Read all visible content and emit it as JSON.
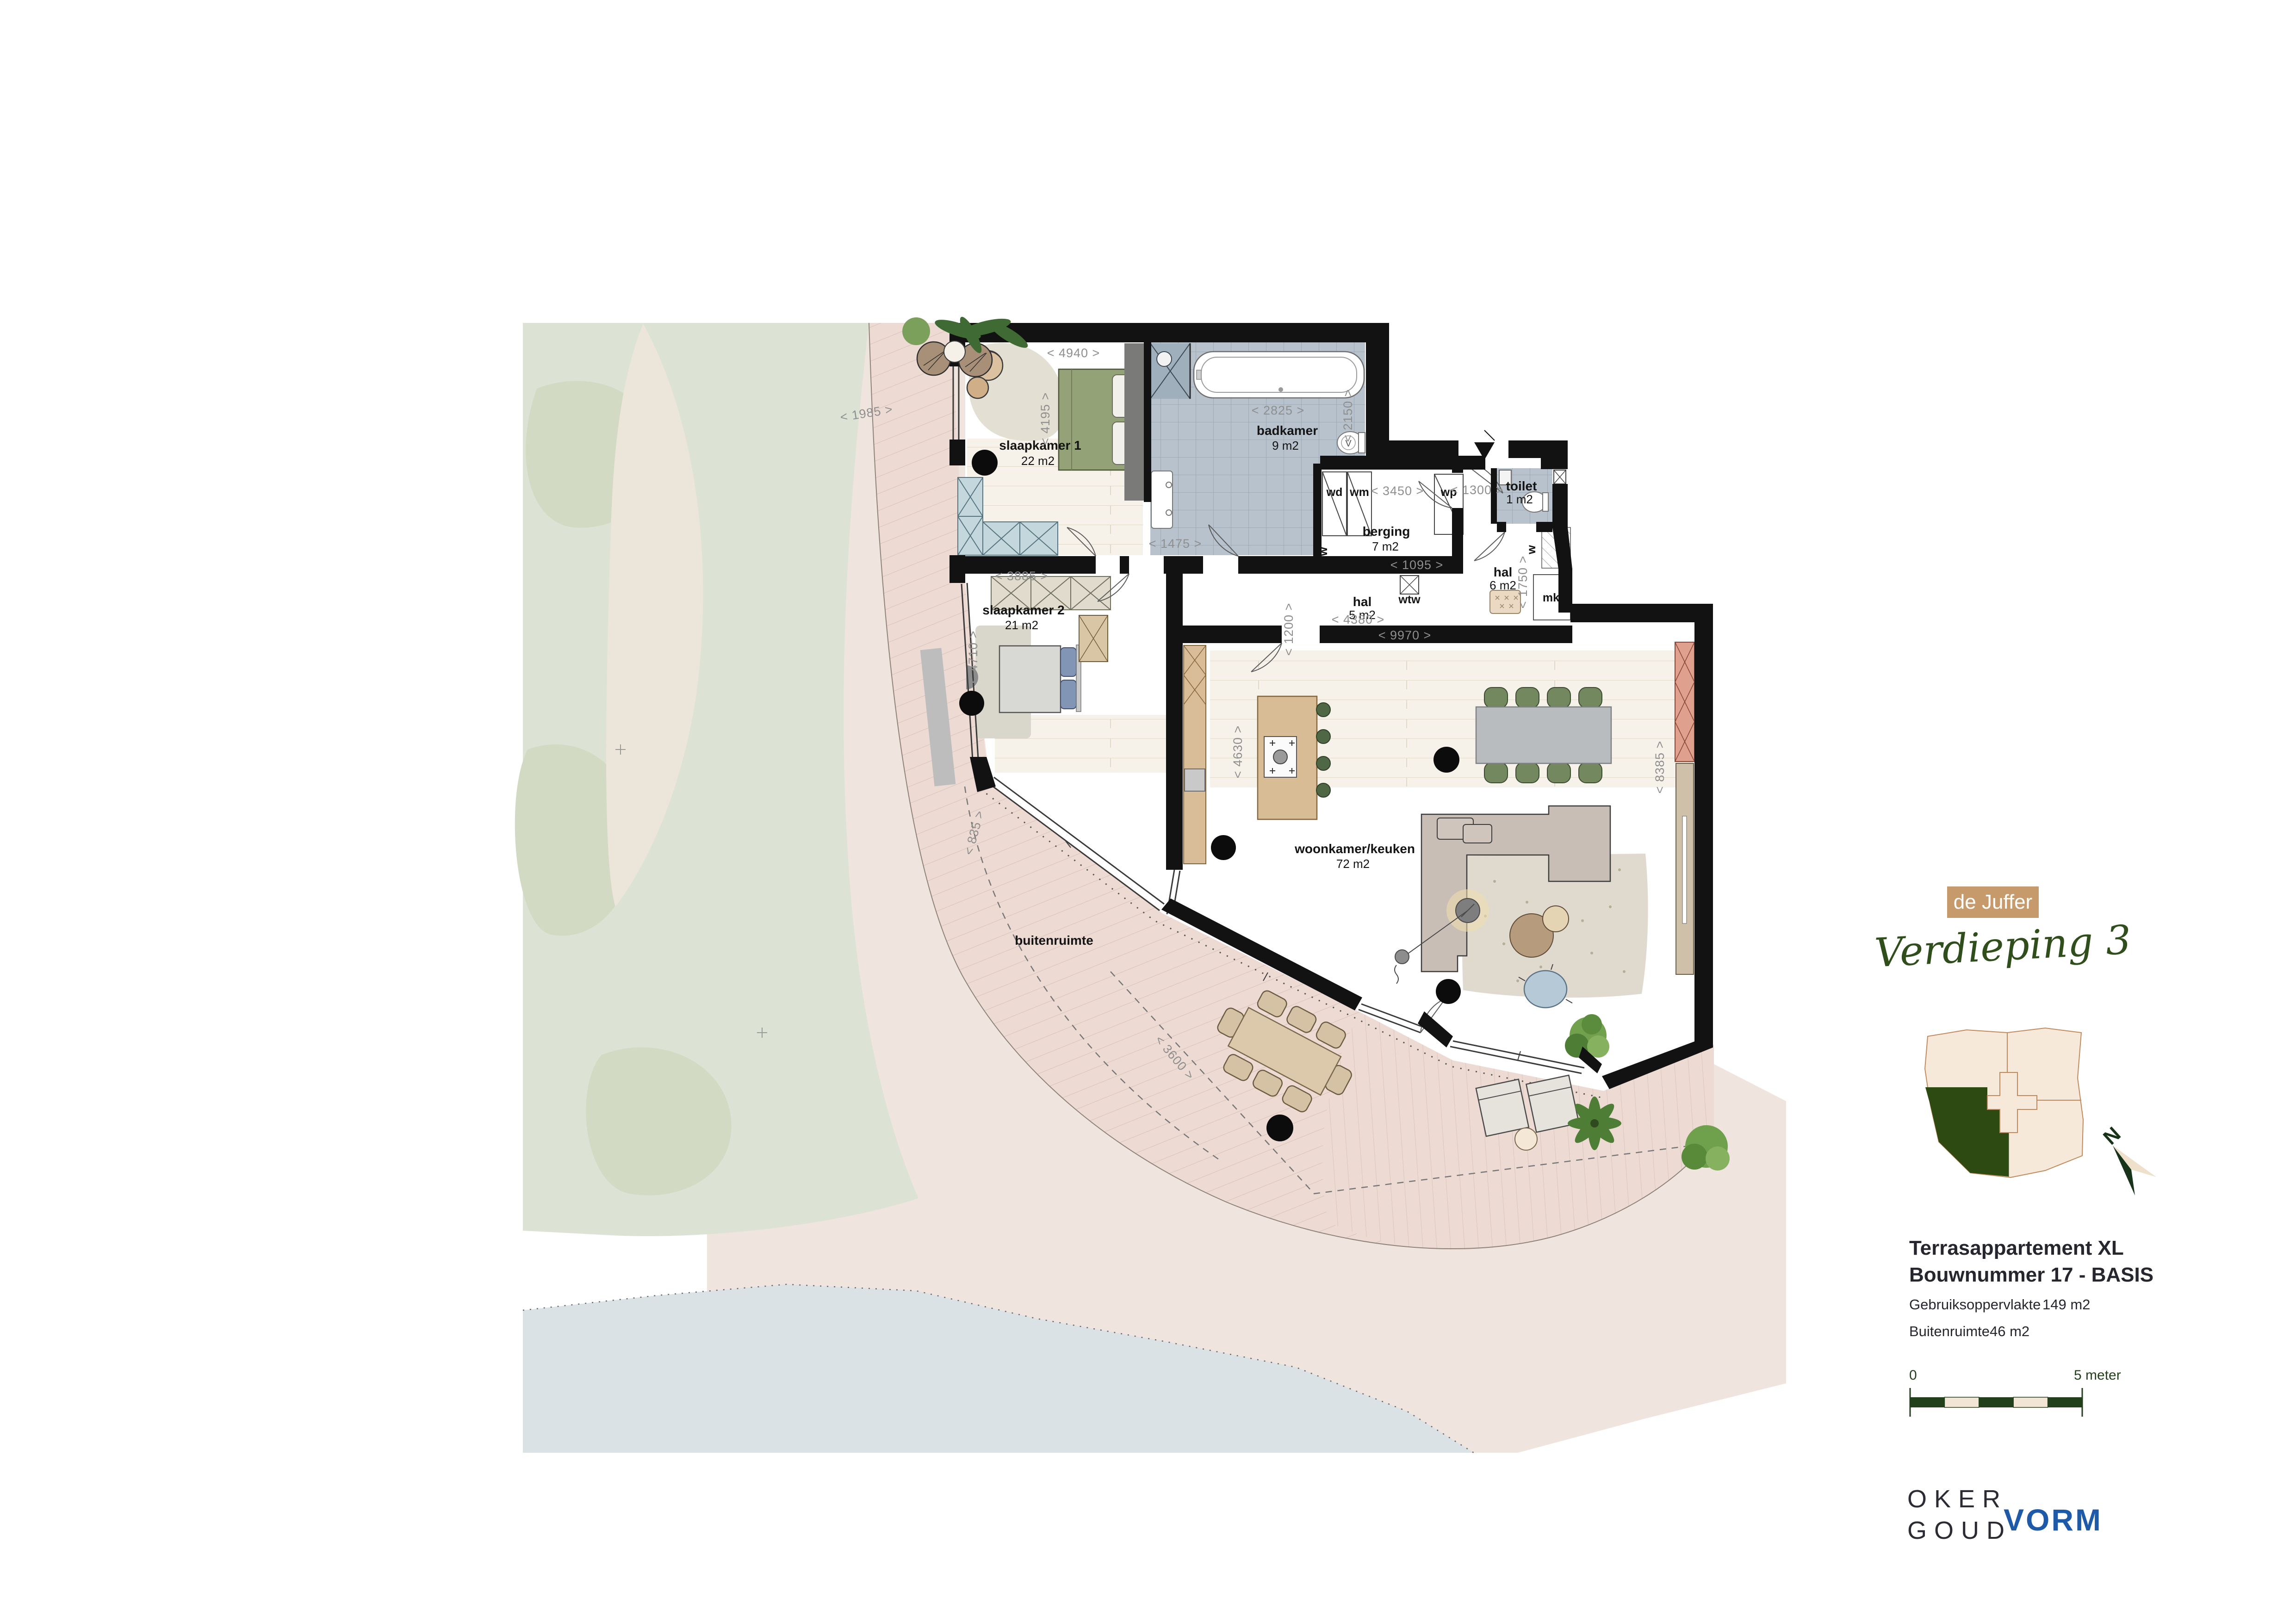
{
  "header": {
    "project_badge": "de Juffer",
    "floor_script": "Verdieping 3"
  },
  "info": {
    "type": "Terrasappartement XL",
    "bouwnummer": "Bouwnummer 17 - BASIS",
    "area_label": "Gebruiksoppervlakte",
    "area_value": "149 m2",
    "outdoor_label": "Buitenruimte",
    "outdoor_value": "46 m2"
  },
  "scalebar": {
    "start": "0",
    "end": "5 meter"
  },
  "logos": {
    "oker_top": "OKER",
    "oker_bottom": "GOUD",
    "vorm": "VORM"
  },
  "compass": {
    "north": "N"
  },
  "rooms": {
    "slaapkamer1": {
      "name": "slaapkamer 1",
      "area": "22 m2"
    },
    "badkamer": {
      "name": "badkamer",
      "area": "9 m2"
    },
    "berging": {
      "name": "berging",
      "area": "7 m2"
    },
    "toilet": {
      "name": "toilet",
      "area": "1 m2"
    },
    "hal5": {
      "name": "hal",
      "area": "5 m2"
    },
    "hal6": {
      "name": "hal",
      "area": "6 m2"
    },
    "slaapkamer2": {
      "name": "slaapkamer 2",
      "area": "21 m2"
    },
    "woonkamer": {
      "name": "woonkamer/keuken",
      "area": "72 m2"
    },
    "buitenruimte": {
      "name": "buitenruimte"
    }
  },
  "fixtures": {
    "wd": "wd",
    "wm": "wm",
    "wp": "wp",
    "wtw": "wtw",
    "mk": "mk",
    "ventilation": "w",
    "toilet_symbol": "V"
  },
  "dims": {
    "slk1_w": "< 4940 >",
    "slk1_h": "< 4195 >",
    "terras_top": "< 1985 >",
    "bad_w": "< 2825 >",
    "bad_h": "< 2150 >",
    "bad_nook": "< 1475 >",
    "berging_w": "< 3450 >",
    "entree": "< 1300 >",
    "berging_d": "< 1095 >",
    "slk2_w": "< 3885 >",
    "slk2_h": "< 4710 >",
    "hal_w": "< 4380 >",
    "hal_door": "< 1200 >",
    "hal6_h": "< 1750 >",
    "woon_w": "< 9970 >",
    "woon_k": "< 4630 >",
    "woon_h": "< 8385 >",
    "terras_left": "< 835 >",
    "terras_diag": "< 3600 >"
  }
}
